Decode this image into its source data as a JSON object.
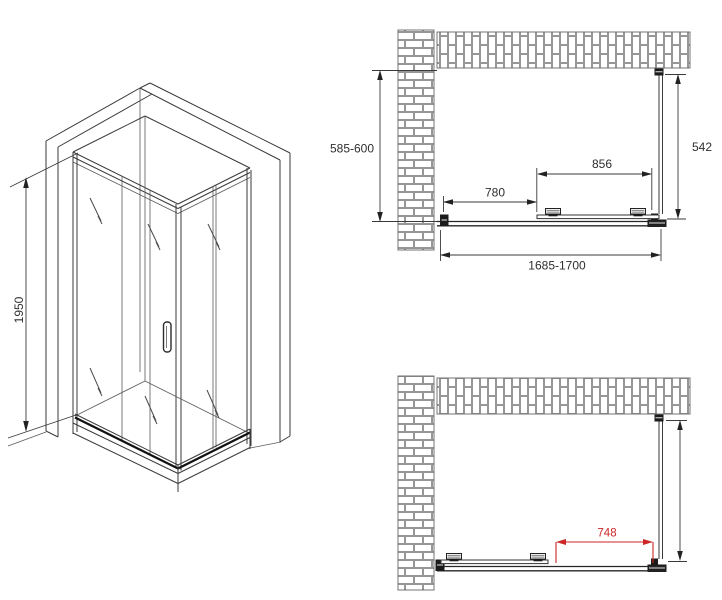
{
  "colors": {
    "line": "#3a3a3a",
    "dark_fittings": "#1b1b1b",
    "brick_line": "#7d7d7d",
    "accent_red": "#cc2626"
  },
  "isometric_view": {
    "height_mm": "1950"
  },
  "top_plan_view": {
    "depth_mm": "585-600",
    "side_panel_mm": "542",
    "fixed_segment_mm": "780",
    "door_segment_mm": "856",
    "overall_width_mm": "1685-1700"
  },
  "bottom_plan_view": {
    "opening_mm": "748"
  }
}
